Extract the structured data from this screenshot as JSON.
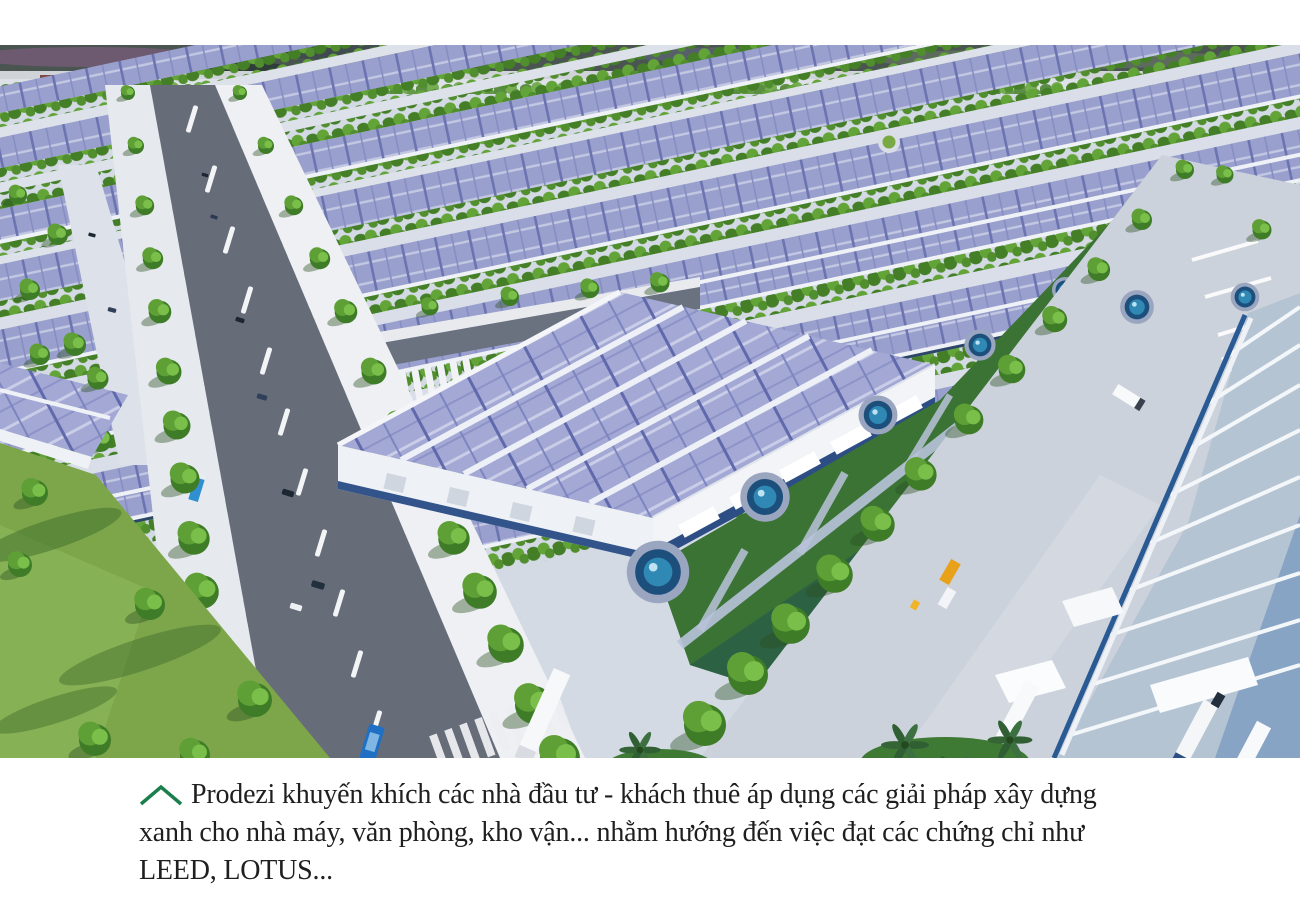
{
  "page": {
    "background": "#ffffff"
  },
  "hero_image": {
    "alt": "Aerial 3D rendering of a green industrial park: rows of warehouses with rooftop solar panels, tree-lined boulevards, lawns with circular fountains, and a logistics yard with trucks and palm trees",
    "palette": {
      "solar_panel": "#a3a8d4",
      "solar_panel_dark": "#6b73b0",
      "tree_green": "#4f8c2f",
      "lawn_green": "#7da64b",
      "courtyard_green": "#3a7334",
      "road_asphalt": "#666d79",
      "pavement": "#ccd2dc",
      "roof_white": "#eef1f6",
      "right_roof": "#b5c4d3",
      "fence_navy": "#123352",
      "water_blue": "#1c4f7c"
    }
  },
  "caption": {
    "icon": "chevron-up-icon",
    "icon_color": "#1b7f4d",
    "text_color": "#1f1f1f",
    "text": "Prodezi khuyến khích các nhà đầu tư - khách thuê áp dụng các giải pháp xây dựng xanh cho nhà máy, văn phòng, kho vận... nhằm hướng đến việc đạt các chứng chỉ như LEED, LOTUS...",
    "lines": [
      "Prodezi khuyến khích các nhà đầu tư - khách thuê áp dụng các giải pháp xây dựng",
      "xanh cho nhà máy, văn phòng, kho vận... nhằm hướng đến việc đạt các chứng chỉ như",
      "LEED, LOTUS..."
    ]
  }
}
